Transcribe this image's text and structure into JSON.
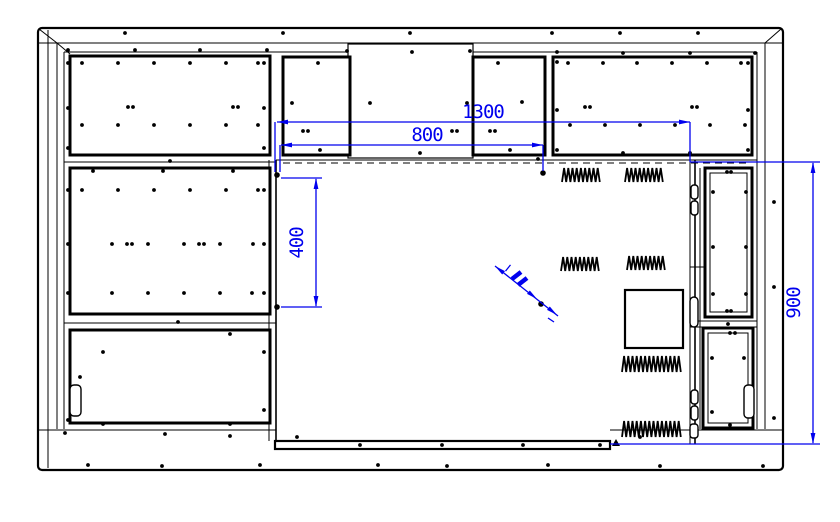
{
  "page": {
    "background": "#ffffff",
    "type": "engineering-drawing"
  },
  "colors": {
    "line": "#000000",
    "dimension": "#0000ee",
    "background": "#ffffff"
  },
  "dimensions": {
    "width_total": {
      "label": "1300"
    },
    "width_inner": {
      "label": "800"
    },
    "height_left": {
      "label": "400"
    },
    "height_right": {
      "label": "900"
    }
  },
  "decor": {
    "screw_dots": [
      [
        125,
        33
      ],
      [
        283,
        33
      ],
      [
        410,
        33
      ],
      [
        552,
        33
      ],
      [
        620,
        33
      ],
      [
        698,
        33
      ],
      [
        68,
        50
      ],
      [
        135,
        50
      ],
      [
        200,
        50
      ],
      [
        267,
        50
      ],
      [
        347,
        51
      ],
      [
        412,
        52
      ],
      [
        470,
        51
      ],
      [
        557,
        52
      ],
      [
        623,
        53
      ],
      [
        690,
        53
      ],
      [
        755,
        53
      ],
      [
        82,
        63
      ],
      [
        118,
        63
      ],
      [
        154,
        63
      ],
      [
        190,
        63
      ],
      [
        226,
        63
      ],
      [
        258,
        63
      ],
      [
        68,
        63
      ],
      [
        68,
        108
      ],
      [
        68,
        148
      ],
      [
        264,
        63
      ],
      [
        264,
        108
      ],
      [
        264,
        148
      ],
      [
        128,
        107
      ],
      [
        133,
        107
      ],
      [
        233,
        107
      ],
      [
        238,
        107
      ],
      [
        82,
        125
      ],
      [
        118,
        125
      ],
      [
        154,
        125
      ],
      [
        190,
        125
      ],
      [
        226,
        125
      ],
      [
        258,
        125
      ],
      [
        170,
        161
      ],
      [
        538,
        159
      ],
      [
        623,
        153
      ],
      [
        690,
        153
      ],
      [
        93,
        171
      ],
      [
        163,
        171
      ],
      [
        233,
        171
      ],
      [
        82,
        190
      ],
      [
        118,
        190
      ],
      [
        154,
        190
      ],
      [
        190,
        190
      ],
      [
        226,
        190
      ],
      [
        258,
        190
      ],
      [
        68,
        190
      ],
      [
        264,
        190
      ],
      [
        112,
        244
      ],
      [
        148,
        244
      ],
      [
        184,
        244
      ],
      [
        220,
        244
      ],
      [
        253,
        244
      ],
      [
        127,
        244
      ],
      [
        132,
        244
      ],
      [
        199,
        244
      ],
      [
        204,
        244
      ],
      [
        68,
        244
      ],
      [
        264,
        244
      ],
      [
        112,
        293
      ],
      [
        148,
        293
      ],
      [
        184,
        293
      ],
      [
        220,
        293
      ],
      [
        252,
        293
      ],
      [
        68,
        293
      ],
      [
        264,
        293
      ],
      [
        178,
        322
      ],
      [
        103,
        352
      ],
      [
        80,
        377
      ],
      [
        68,
        420
      ],
      [
        103,
        424
      ],
      [
        230,
        424
      ],
      [
        264,
        352
      ],
      [
        264,
        410
      ],
      [
        230,
        334
      ],
      [
        318,
        63
      ],
      [
        292,
        103
      ],
      [
        303,
        131
      ],
      [
        308,
        131
      ],
      [
        320,
        150
      ],
      [
        370,
        103
      ],
      [
        467,
        103
      ],
      [
        452,
        131
      ],
      [
        457,
        131
      ],
      [
        420,
        153
      ],
      [
        498,
        63
      ],
      [
        522,
        102
      ],
      [
        490,
        131
      ],
      [
        495,
        131
      ],
      [
        510,
        150
      ],
      [
        568,
        63
      ],
      [
        603,
        63
      ],
      [
        637,
        63
      ],
      [
        672,
        63
      ],
      [
        707,
        63
      ],
      [
        741,
        63
      ],
      [
        585,
        107
      ],
      [
        590,
        107
      ],
      [
        692,
        107
      ],
      [
        697,
        107
      ],
      [
        570,
        125
      ],
      [
        605,
        125
      ],
      [
        640,
        125
      ],
      [
        675,
        125
      ],
      [
        710,
        125
      ],
      [
        745,
        125
      ],
      [
        557,
        62
      ],
      [
        557,
        110
      ],
      [
        557,
        150
      ],
      [
        748,
        63
      ],
      [
        748,
        110
      ],
      [
        748,
        150
      ],
      [
        727,
        172
      ],
      [
        731,
        172
      ],
      [
        713,
        192
      ],
      [
        746,
        192
      ],
      [
        713,
        247
      ],
      [
        746,
        247
      ],
      [
        713,
        294
      ],
      [
        746,
        294
      ],
      [
        727,
        311
      ],
      [
        731,
        311
      ],
      [
        728,
        324
      ],
      [
        730,
        333
      ],
      [
        735,
        333
      ],
      [
        712,
        358
      ],
      [
        744,
        358
      ],
      [
        712,
        412
      ],
      [
        730,
        425
      ],
      [
        774,
        202
      ],
      [
        774,
        287
      ],
      [
        774,
        418
      ],
      [
        360,
        445
      ],
      [
        442,
        445
      ],
      [
        523,
        445
      ],
      [
        600,
        445
      ],
      [
        65,
        433
      ],
      [
        165,
        434
      ],
      [
        230,
        436
      ],
      [
        297,
        437
      ],
      [
        640,
        437
      ],
      [
        88,
        465
      ],
      [
        162,
        466
      ],
      [
        260,
        465
      ],
      [
        378,
        465
      ],
      [
        447,
        466
      ],
      [
        548,
        465
      ],
      [
        660,
        466
      ],
      [
        763,
        466
      ]
    ],
    "vents": [
      {
        "x": 562,
        "y": 168,
        "w": 40,
        "h": 14
      },
      {
        "x": 625,
        "y": 168,
        "w": 40,
        "h": 14
      },
      {
        "x": 561,
        "y": 257,
        "w": 39,
        "h": 14
      },
      {
        "x": 627,
        "y": 256,
        "w": 38,
        "h": 14
      },
      {
        "x": 622,
        "y": 356,
        "w": 61,
        "h": 16
      },
      {
        "x": 622,
        "y": 421,
        "w": 61,
        "h": 16
      }
    ]
  }
}
